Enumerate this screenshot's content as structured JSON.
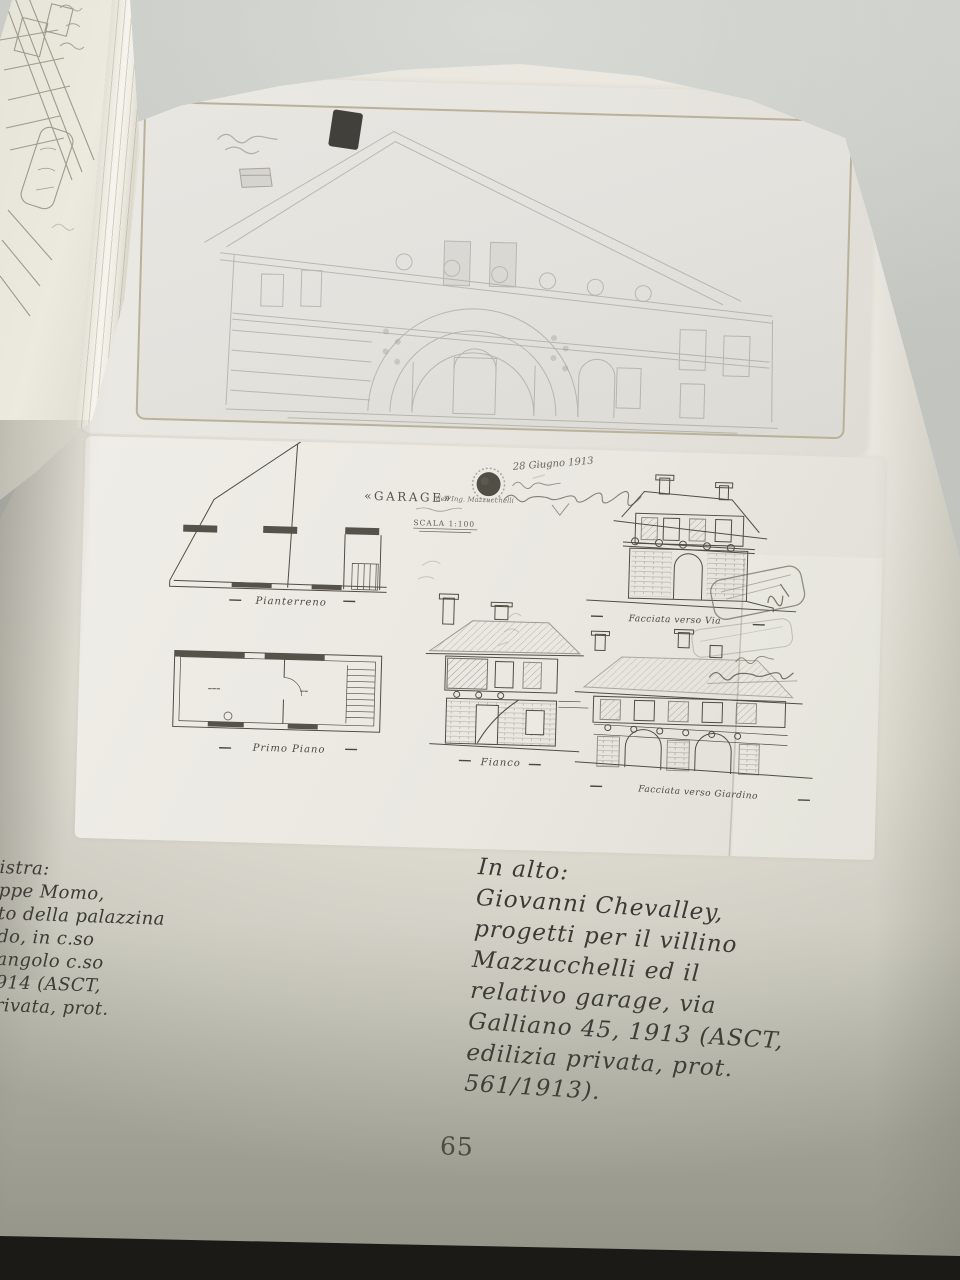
{
  "page": {
    "number": "65",
    "caption_left": {
      "lines": [
        "istra:",
        "ppe Momo,",
        "to della palazzina",
        "do, in c.so",
        "angolo c.so",
        "914 (ASCT,",
        "rivata, prot."
      ]
    },
    "caption_right": {
      "lines": [
        "In alto:",
        "Giovanni Chevalley,",
        "progetti per il villino",
        "Mazzucchelli ed il",
        "relativo garage, via",
        "Galliano 45, 1913 (ASCT,",
        "edilizia privata, prot.",
        "561/1913)."
      ]
    }
  },
  "plate_bottom": {
    "handwritten_date": "28 Giugno 1913",
    "title": "«GARAGE»",
    "title_suffix": "dell'Ing. Mazzucchelli",
    "scale": "SCALA 1:100",
    "labels": {
      "plan_ground": "Pianterreno",
      "plan_first": "Primo Piano",
      "side": "Fianco",
      "front_street": "Facciata verso Via",
      "front_garden": "Facciata verso Giardino"
    }
  },
  "colors": {
    "table": "#c4c6c2",
    "page": "#e8e5dc",
    "plate": "#eae8e1",
    "frame_line": "#b9b199",
    "ink": "#55524a",
    "caption_ink": "#3b3a34",
    "dark_edge": "#24221d"
  }
}
